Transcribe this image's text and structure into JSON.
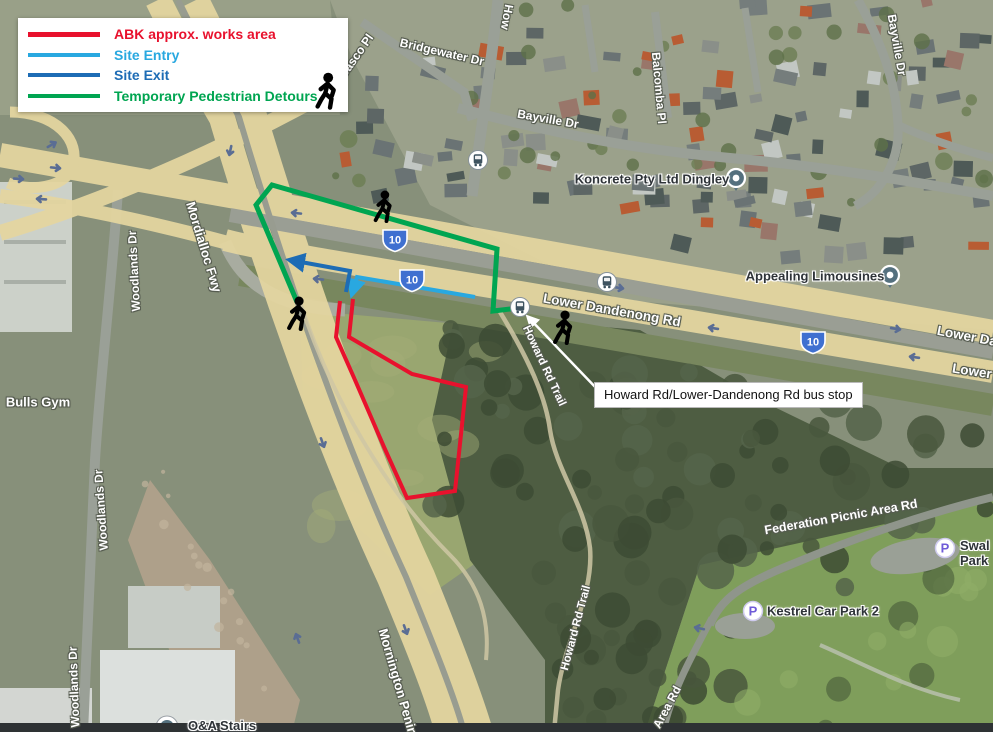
{
  "legend": {
    "items": [
      {
        "label": "ABK approx. works area"
      },
      {
        "label": "Site Entry"
      },
      {
        "label": "Site Exit"
      },
      {
        "label": "Temporary Pedestrian Detours"
      }
    ]
  },
  "colors": {
    "works": "#e8112d",
    "entry": "#29a8e0",
    "exit": "#1d6cb5",
    "detour": "#00a551",
    "callout_arrow": "#ffffff"
  },
  "callout": {
    "text": "Howard Rd/Lower-Dandenong Rd bus stop"
  },
  "route_shield": "10",
  "labels": {
    "bridgewater": "Bridgewater Dr",
    "casco": "Casco Pl",
    "howard_top": "How",
    "bayville_top": "Bayville Dr",
    "balcomba": "Balcomba Pl",
    "bayville_right": "Bayville Dr",
    "koncrete": "Koncrete Pty Ltd Dingley",
    "appealing": "Appealing Limousines",
    "lower_dandenong": "Lower Dandenong Rd",
    "lower_da_right": "Lower Da",
    "lower_right": "Lower",
    "mordialloc": "Mordialloc Fwy",
    "woodlands1": "Woodlands Dr",
    "woodlands2": "Woodlands Dr",
    "woodlands3": "Woodlands Dr",
    "bulls_gym": "Bulls Gym",
    "mornington": "Mornington Penin",
    "howard_trail1": "Howard Rd Trail",
    "howard_trail2": "Howard Rd Trail",
    "federation": "Federation Picnic Area Rd",
    "area_rd": "Area Rd",
    "kestrel": "Kestrel Car Park 2",
    "swal_line1": "Swal",
    "swal_line2": "Park",
    "stairs": "O&A Stairs",
    "parking_p": "P"
  }
}
